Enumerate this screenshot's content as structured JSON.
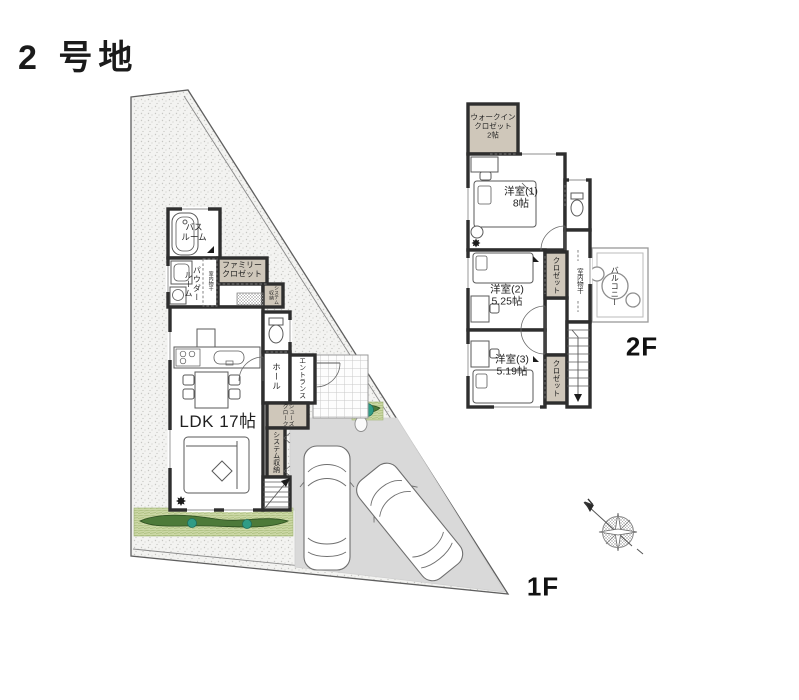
{
  "title": "2 号地",
  "floor1": {
    "label": "1F",
    "bath": "バス\nルーム",
    "powder": "パウダー\nルーム",
    "indoor_drying": "室内物干",
    "family_closet": "ファミリー\nクロゼット",
    "system_storage_small": "システム\n収納",
    "hall": "ホール",
    "entrance": "エントランス",
    "shoes_closet": "シューズ\nクローク",
    "system_storage": "システム収納",
    "ldk": "LDK 17帖"
  },
  "floor2": {
    "label": "2F",
    "walk_in_closet": "ウォークイン\nクロゼット\n2帖",
    "room1": "洋室(1)\n8帖",
    "room2": "洋室(2)\n5.25帖",
    "room3": "洋室(3)\n5.19帖",
    "closet2": "クロゼット",
    "closet3": "クロゼット",
    "indoor_drying": "室内物干",
    "balcony": "バルコニー"
  },
  "compass": {
    "north": "N"
  },
  "colors": {
    "wall": "#2e2e2e",
    "closet_fill": "#cfc7ba",
    "driveway": "#d9d9d9",
    "grass_light": "#ccd8a6",
    "grass_dark": "#4d7a39",
    "bush": "#2f9c86",
    "ground": "#f3f3f1",
    "ground_dot": "#c6c6c3"
  }
}
